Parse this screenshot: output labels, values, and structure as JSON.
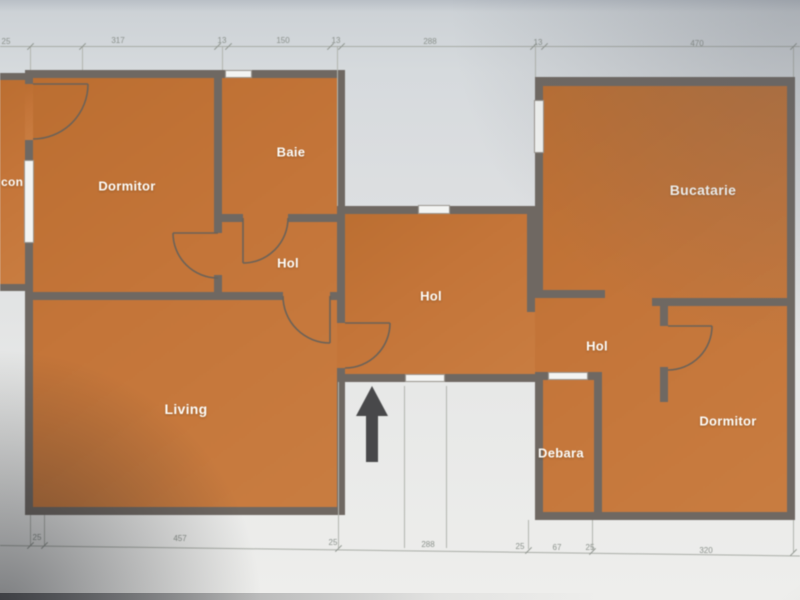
{
  "floor_plan": {
    "title": "apartment-floor-plan-photo",
    "rooms": [
      {
        "id": "balcony",
        "label": "con"
      },
      {
        "id": "bedroom-1",
        "label": "Dormitor"
      },
      {
        "id": "bathroom",
        "label": "Baie"
      },
      {
        "id": "hall-small",
        "label": "Hol"
      },
      {
        "id": "hall-center",
        "label": "Hol"
      },
      {
        "id": "living",
        "label": "Living"
      },
      {
        "id": "kitchen",
        "label": "Bucatarie"
      },
      {
        "id": "hall-right",
        "label": "Hol"
      },
      {
        "id": "pantry",
        "label": "Debara"
      },
      {
        "id": "bedroom-2",
        "label": "Dormitor"
      }
    ],
    "dimensions_top": [
      "25",
      "317",
      "13",
      "150",
      "13",
      "288",
      "13",
      "470"
    ],
    "dimensions_bottom": [
      "25",
      "457",
      "25",
      "288",
      "25",
      "67",
      "25",
      "320"
    ],
    "icons": {
      "entrance_arrow": "arrow-up"
    },
    "colors": {
      "room_fill": "#c47539",
      "wall": "#6f6862",
      "background": "#dddfe1",
      "room_label": "#fdfdfa",
      "dimension_text": "#8b918c",
      "arrow": "#48484a"
    }
  }
}
